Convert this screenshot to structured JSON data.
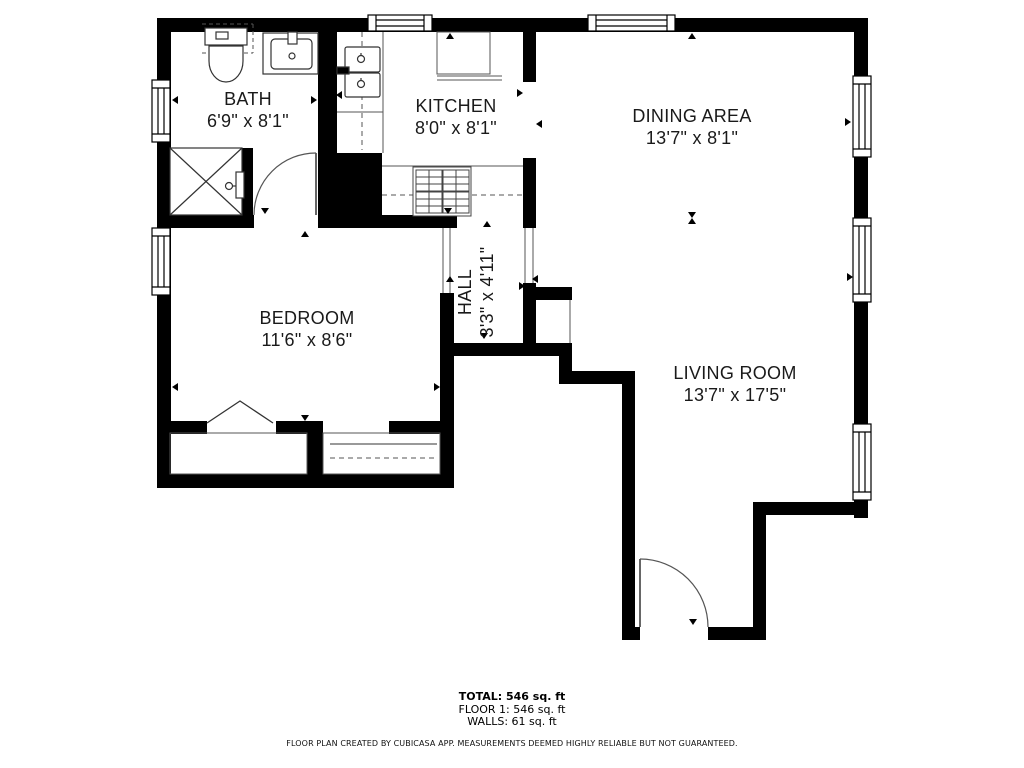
{
  "rooms": [
    {
      "name": "BATH",
      "dims": "6'9\" x 8'1\""
    },
    {
      "name": "KITCHEN",
      "dims": "8'0\" x 8'1\""
    },
    {
      "name": "DINING AREA",
      "dims": "13'7\" x 8'1\""
    },
    {
      "name": "BEDROOM",
      "dims": "11'6\" x 8'6\""
    },
    {
      "name": "HALL",
      "dims": "3'3\" x 4'11\""
    },
    {
      "name": "LIVING ROOM",
      "dims": "13'7\" x 17'5\""
    }
  ],
  "summary": {
    "total": "TOTAL: 546 sq. ft",
    "floor": "FLOOR 1: 546 sq. ft",
    "walls": "WALLS: 61 sq. ft"
  },
  "disclaimer": "FLOOR PLAN CREATED BY CUBICASA APP. MEASUREMENTS DEEMED HIGHLY RELIABLE BUT NOT GUARANTEED.",
  "colors": {
    "wall": "#000000",
    "background": "#ffffff",
    "thin_line": "#555555",
    "text": "#1a1a1a"
  }
}
